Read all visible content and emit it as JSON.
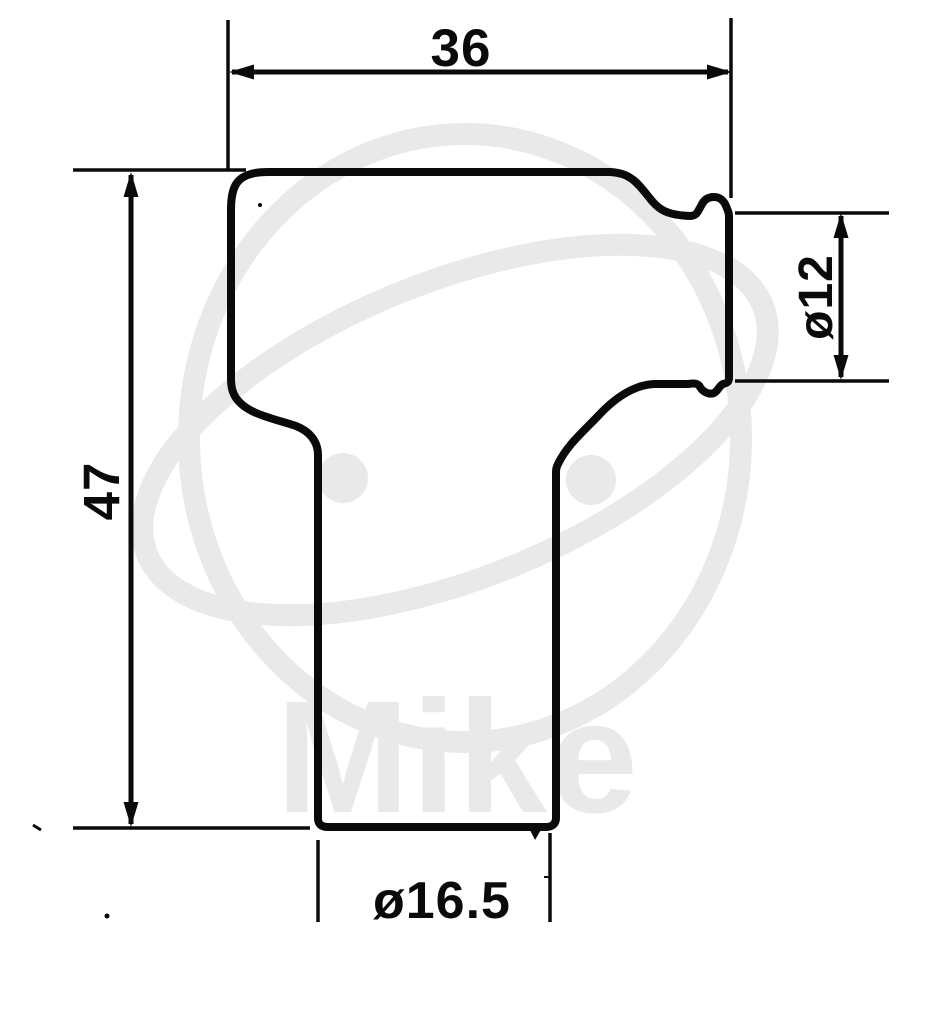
{
  "page": {
    "title": "Spark plug cap technical drawing"
  },
  "drawing": {
    "dimensions": {
      "top_width": "36",
      "side_height": "47",
      "terminal_diameter": "ø12",
      "base_diameter": "ø16.5"
    },
    "watermark_text": "Mike",
    "colors": {
      "ink": "#0a0a0a",
      "background": "#ffffff",
      "watermark": "#e9e9e9"
    }
  }
}
